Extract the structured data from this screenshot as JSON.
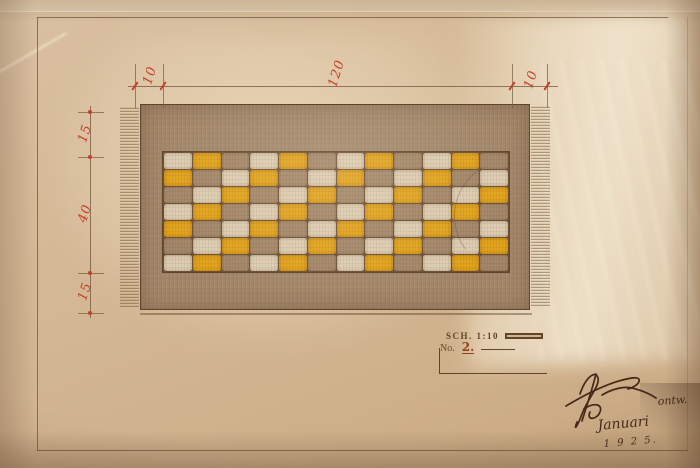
{
  "dimensions_top": {
    "left": "10",
    "middle": "120",
    "right": "10"
  },
  "dimensions_left": {
    "top": "15",
    "middle": "40",
    "bottom": "15"
  },
  "title_block": {
    "scale_label": "SCH. 1:10",
    "number_prefix": "No.",
    "number_value": "2."
  },
  "signature": {
    "annotation": "ontw.",
    "line2": "Januari",
    "line3": "1 9 2 5."
  },
  "rug": {
    "rows": 7,
    "columns": 12,
    "pattern_rows": [
      "WYBWYBWYBWYB",
      "YBWYBWYBWYBW",
      "BWYBWYBWYBWY",
      "WYBWYBWYBWYB",
      "YBWYBWYBWYBW",
      "BWYBWYBWYBWY",
      "WYBWYBWYBWYB"
    ],
    "colors": {
      "Y": "#e2a41c",
      "W": "#dccdb3",
      "B": "#a3876a",
      "grid": "#6e5137",
      "accent_red": "#c5402a",
      "ink": "#654327",
      "paper": "#d5b996"
    }
  }
}
